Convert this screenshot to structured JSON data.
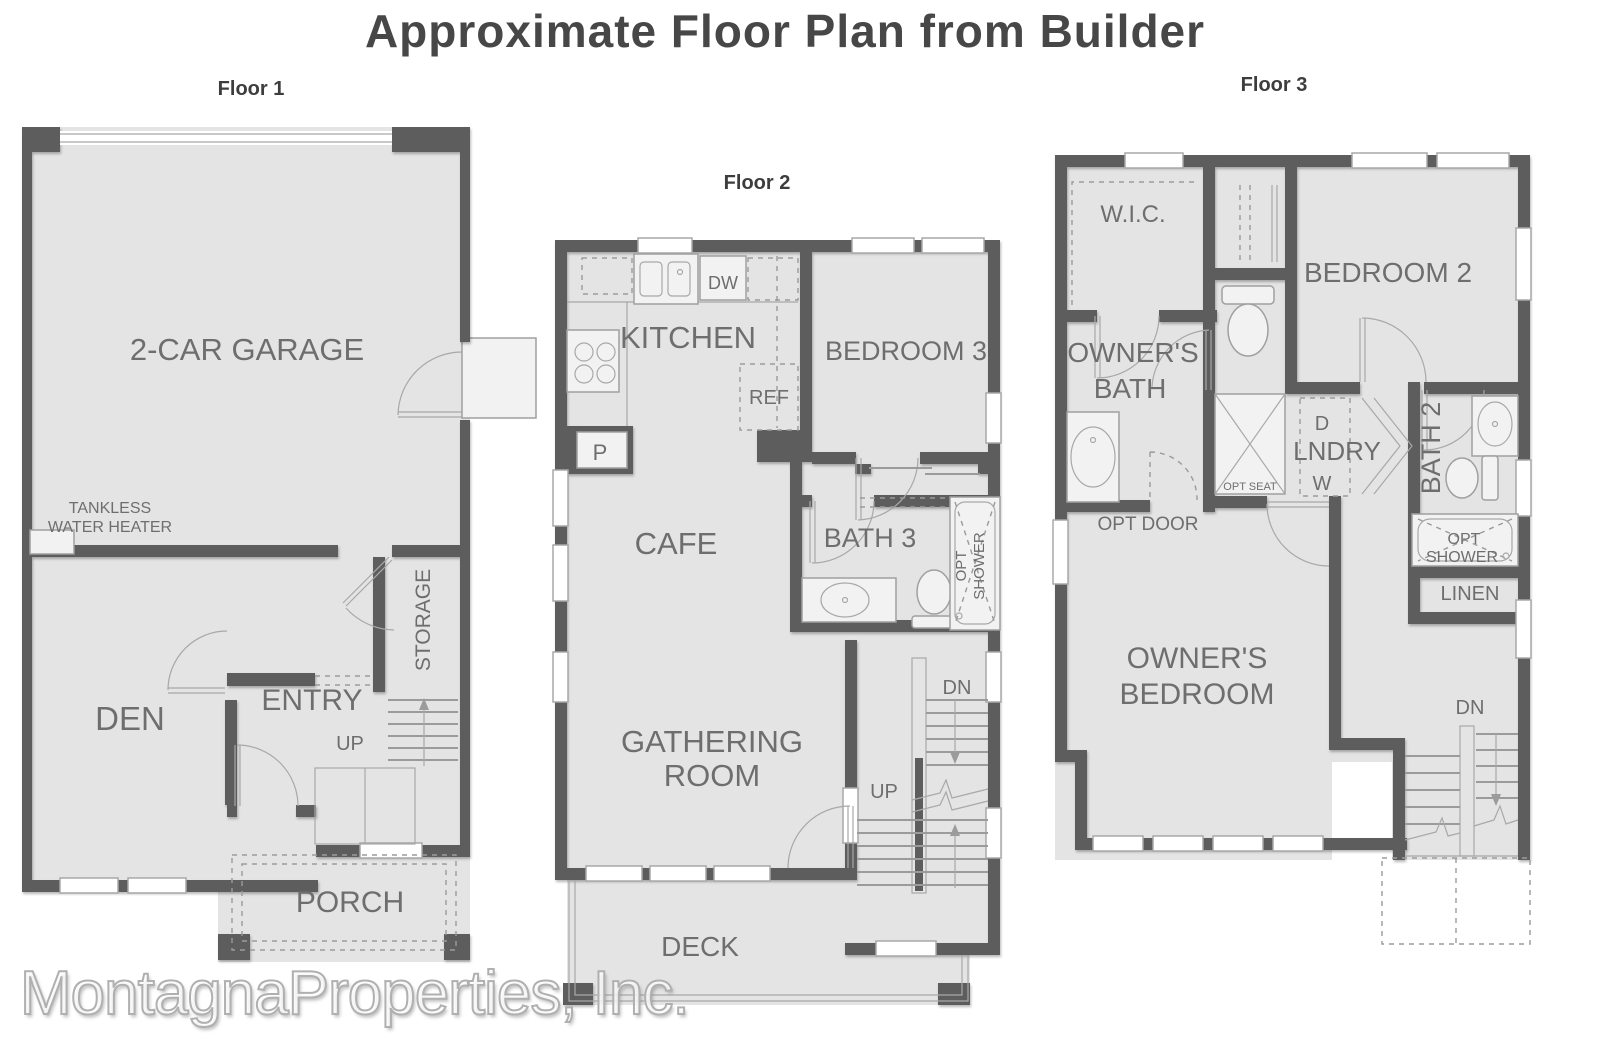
{
  "title": "Approximate Floor Plan from Builder",
  "watermark": "MontagnaProperties, Inc.",
  "colors": {
    "wall": "#5d5d5d",
    "room_fill": "#e4e4e4",
    "fixture_line": "#9b9b9b",
    "label_text": "#6e6e6e",
    "title_text": "#474747",
    "watermark_outline": "#b0b0b0"
  },
  "floor1": {
    "name": "Floor 1",
    "labels": {
      "garage": "2-CAR GARAGE",
      "tankless1": "TANKLESS",
      "tankless2": "WATER HEATER",
      "den": "DEN",
      "entry": "ENTRY",
      "storage": "STORAGE",
      "up": "UP",
      "porch": "PORCH"
    }
  },
  "floor2": {
    "name": "Floor 2",
    "labels": {
      "kitchen": "KITCHEN",
      "dw": "DW",
      "ref": "REF",
      "pantry": "P",
      "cafe": "CAFE",
      "bedroom3": "BEDROOM 3",
      "bath3": "BATH 3",
      "opt1": "OPT",
      "opt2": "SHOWER",
      "gathering1": "GATHERING",
      "gathering2": "ROOM",
      "up": "UP",
      "dn": "DN",
      "deck": "DECK"
    }
  },
  "floor3": {
    "name": "Floor 3",
    "labels": {
      "wic": "W.I.C.",
      "ownersbath1": "OWNER'S",
      "ownersbath2": "BATH",
      "bedroom2": "BEDROOM 2",
      "laundry_d": "D",
      "lndry": "LNDRY",
      "laundry_w": "W",
      "bath2": "BATH 2",
      "optseat": "OPT SEAT",
      "optdoor": "OPT DOOR",
      "opt1": "OPT",
      "opt2": "SHOWER",
      "linen": "LINEN",
      "ownersbed1": "OWNER'S",
      "ownersbed2": "BEDROOM",
      "dn": "DN"
    }
  }
}
